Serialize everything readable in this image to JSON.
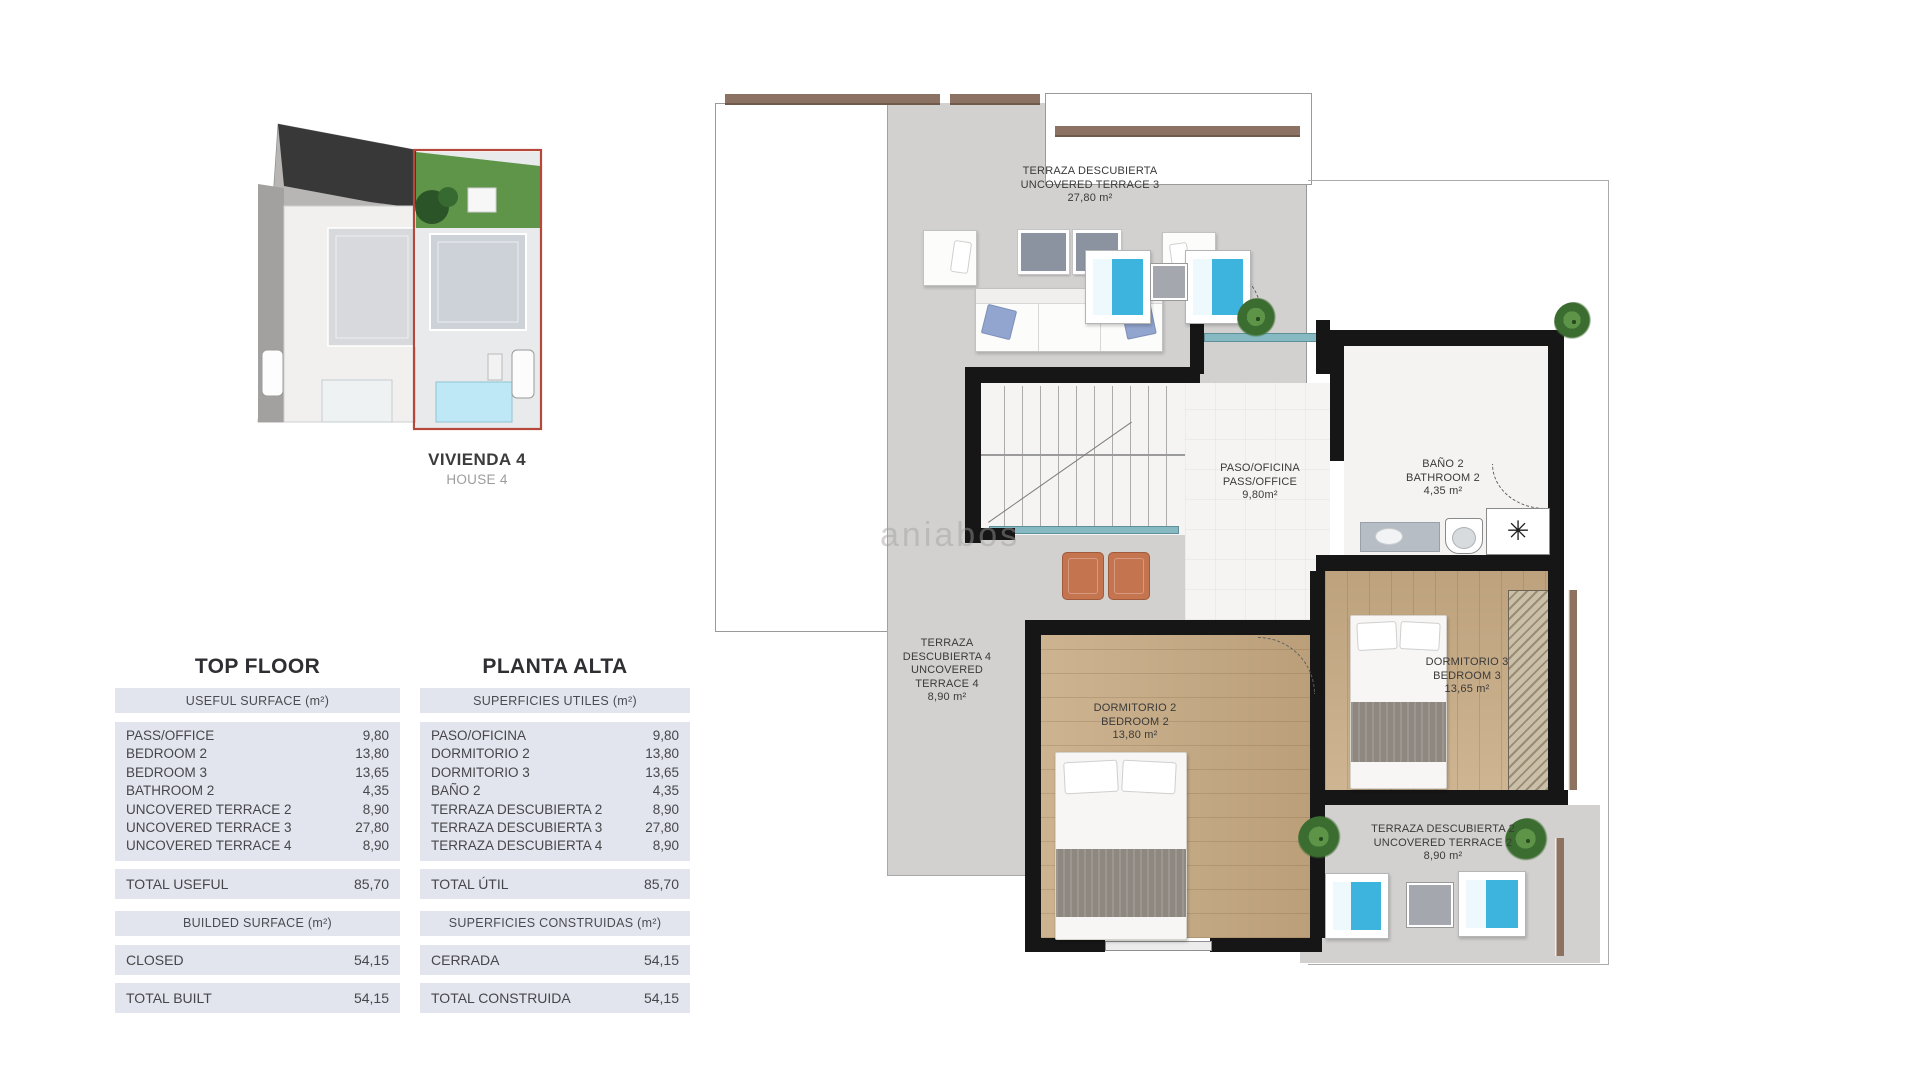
{
  "site_plan": {
    "title": "VIVIENDA 4",
    "subtitle": "HOUSE 4"
  },
  "tables": {
    "en": {
      "title": "TOP FLOOR",
      "section1_header": "USEFUL SURFACE (m²)",
      "rows": [
        {
          "label": "PASS/OFFICE",
          "value": "9,80"
        },
        {
          "label": "BEDROOM 2",
          "value": "13,80"
        },
        {
          "label": "BEDROOM 3",
          "value": "13,65"
        },
        {
          "label": "BATHROOM 2",
          "value": "4,35"
        },
        {
          "label": "UNCOVERED TERRACE 2",
          "value": "8,90"
        },
        {
          "label": "UNCOVERED TERRACE 3",
          "value": "27,80"
        },
        {
          "label": "UNCOVERED TERRACE 4",
          "value": "8,90"
        }
      ],
      "total_label": "TOTAL USEFUL",
      "total_value": "85,70",
      "section2_header": "BUILDED SURFACE (m²)",
      "closed_label": "CLOSED",
      "closed_value": "54,15",
      "built_label": "TOTAL BUILT",
      "built_value": "54,15"
    },
    "es": {
      "title": "PLANTA ALTA",
      "section1_header": "SUPERFICIES UTILES (m²)",
      "rows": [
        {
          "label": "PASO/OFICINA",
          "value": "9,80"
        },
        {
          "label": "DORMITORIO 2",
          "value": "13,80"
        },
        {
          "label": "DORMITORIO 3",
          "value": "13,65"
        },
        {
          "label": "BAÑO 2",
          "value": "4,35"
        },
        {
          "label": "TERRAZA DESCUBIERTA 2",
          "value": "8,90"
        },
        {
          "label": "TERRAZA DESCUBIERTA 3",
          "value": "27,80"
        },
        {
          "label": "TERRAZA DESCUBIERTA 4",
          "value": "8,90"
        }
      ],
      "total_label": "TOTAL ÚTIL",
      "total_value": "85,70",
      "section2_header": "SUPERFICIES CONSTRUIDAS (m²)",
      "closed_label": "CERRADA",
      "closed_value": "54,15",
      "built_label": "TOTAL CONSTRUIDA",
      "built_value": "54,15"
    }
  },
  "plan": {
    "watermark": "aniabos",
    "rooms": {
      "terrace3": {
        "lines": [
          "TERRAZA DESCUBIERTA",
          "UNCOVERED TERRACE 3",
          "27,80 m²"
        ]
      },
      "terrace4": {
        "lines": [
          "TERRAZA",
          "DESCUBIERTA 4",
          "UNCOVERED",
          "TERRACE 4",
          "8,90 m²"
        ]
      },
      "pass_office": {
        "lines": [
          "PASO/OFICINA",
          "PASS/OFFICE",
          "9,80m²"
        ]
      },
      "bathroom2": {
        "lines": [
          "BAÑO 2",
          "BATHROOM 2",
          "4,35 m²"
        ]
      },
      "bedroom2": {
        "lines": [
          "DORMITORIO 2",
          "BEDROOM 2",
          "13,80 m²"
        ]
      },
      "bedroom3": {
        "lines": [
          "DORMITORIO 3",
          "BEDROOM 3",
          "13,65 m²"
        ]
      },
      "terrace2": {
        "lines": [
          "TERRAZA DESCUBIERTA 2",
          "UNCOVERED TERRACE 2",
          "8,90 m²"
        ]
      }
    }
  }
}
